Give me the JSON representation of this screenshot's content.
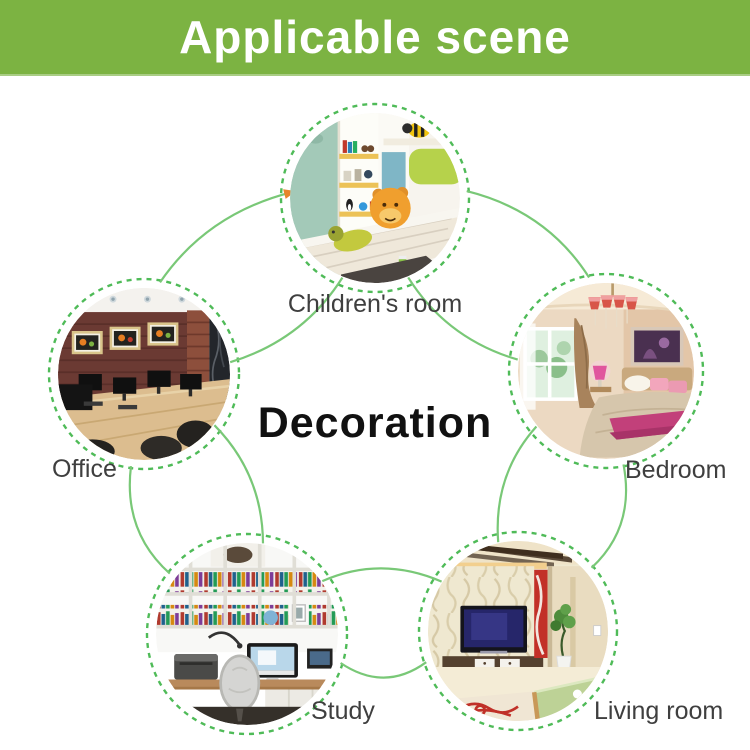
{
  "banner": {
    "title": "Applicable scene",
    "bg_color": "#7cb342",
    "text_color": "#ffffff"
  },
  "diagram": {
    "center_label": "Decoration",
    "nodes": [
      {
        "id": "children-room",
        "label": "Children's room"
      },
      {
        "id": "bedroom",
        "label": "Bedroom"
      },
      {
        "id": "living-room",
        "label": "Living room"
      },
      {
        "id": "study",
        "label": "Study"
      },
      {
        "id": "office",
        "label": "Office"
      }
    ],
    "icons": [
      {
        "name": "arrow-icon",
        "meaning": "flow arrowhead entering children's room circle"
      }
    ],
    "colors": {
      "connector": "#79c877",
      "ring": "#4fbb58",
      "arrow": "#e8842a",
      "label": "#3f3f3f",
      "center_text": "#111111"
    }
  }
}
